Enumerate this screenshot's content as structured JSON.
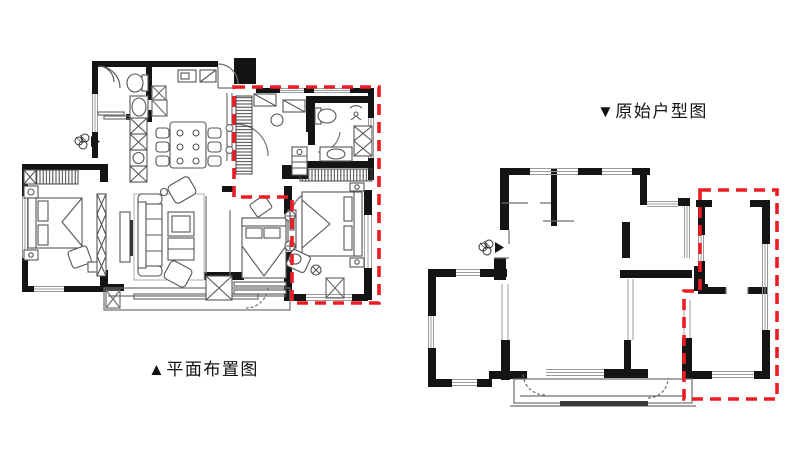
{
  "page": {
    "background": "#ffffff"
  },
  "captions": {
    "left": "▲平面布置图",
    "right": "▼原始户型图"
  },
  "colors": {
    "wall": "#141414",
    "line": "#6f6f6f",
    "furniture": "#555555",
    "window": "#9b9b9b",
    "highlight": "#ed1c24",
    "rail": "#3a3a3a"
  },
  "icons": {
    "entry_marker": "entry-marker"
  }
}
